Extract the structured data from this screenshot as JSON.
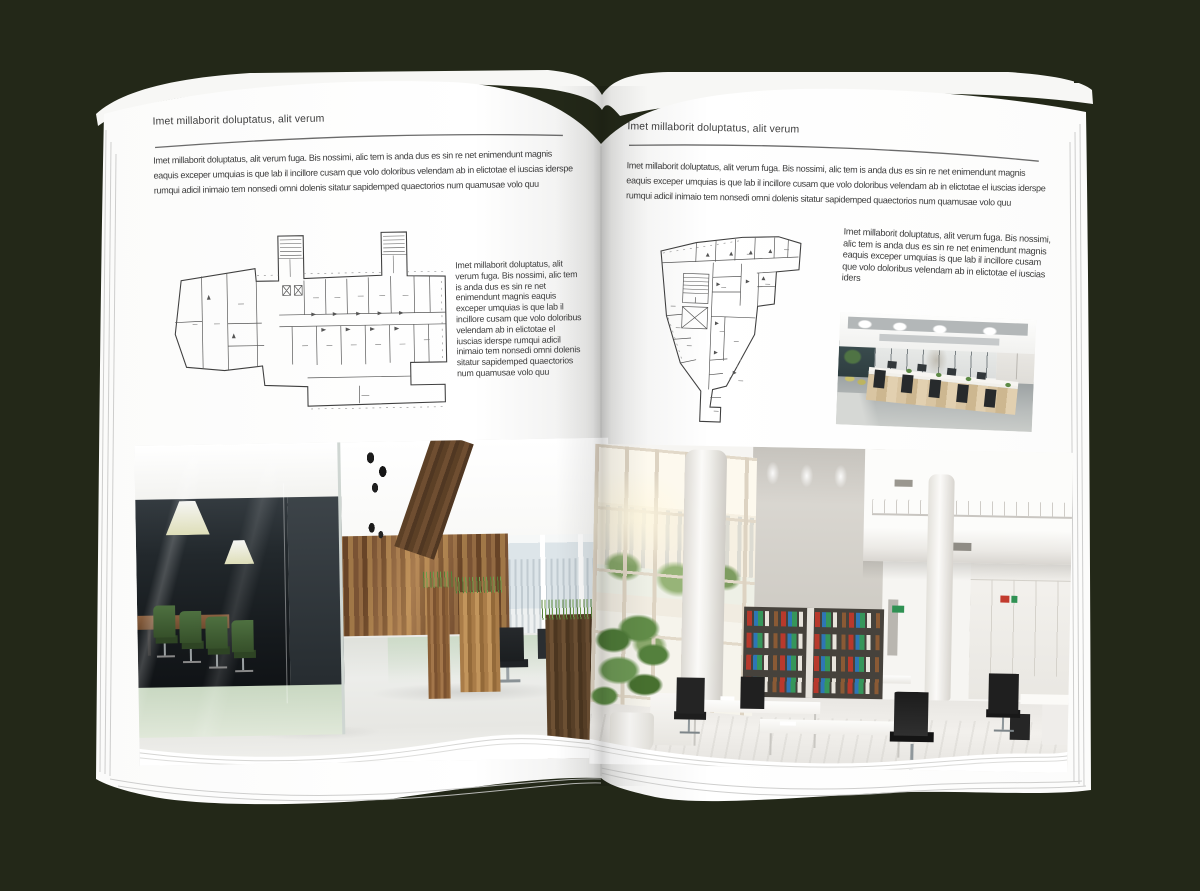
{
  "background_color": "#232818",
  "page_color": "#ffffff",
  "text_color": "#3c3c3c",
  "left_page": {
    "header": "Imet millaborit doluptatus, alit verum",
    "intro": "Imet millaborit doluptatus, alit verum fuga. Bis nossimi, alic tem is anda dus es sin re net enimendunt magnis eaquis exceper umquias is que lab il incillore cusam que volo doloribus velendam ab in elictotae el iuscias iderspe rumqui adicil inimaio tem nonsedi omni dolenis sitatur sapidemped quaectorios num quamusae volo quu",
    "side_text": "Imet millaborit doluptatus, alit verum fuga. Bis nossimi, alic tem is anda dus es sin re net enimendunt magnis eaquis exceper umquias is que lab il incillore cusam que volo doloribus velendam ab in elictotae el iuscias iderspe rumqui adicil inimaio tem nonsedi omni dolenis sitatur sapidemped quaectorios num quamusae volo quu",
    "floor_plan_icon": "building-floor-plan-wide",
    "photo_icon": "office-interior-wood-glass-meeting-room"
  },
  "right_page": {
    "header": "Imet millaborit doluptatus, alit verum",
    "intro": "Imet millaborit doluptatus, alit verum fuga. Bis nossimi, alic tem is anda dus es sin re net enimendunt magnis eaquis exceper umquias is que lab il incillore cusam que volo doloribus velendam ab in elictotae el iuscias iderspe rumqui adicil inimaio tem nonsedi omni dolenis sitatur sapidemped quaectorios num quamusae volo quu",
    "side_text": "Imet millaborit doluptatus, alit verum fuga. Bis nossimi, alic tem is anda dus es sin re net enimendunt magnis eaquis exceper umquias is que lab il incillore cusam que volo doloribus velendam ab in elictotae el iuscias iders",
    "floor_plan_icon": "building-floor-plan-tall",
    "photo_small_icon": "office-interior-open-space-desks",
    "photo_large_icon": "office-interior-white-atrium-bookshelves"
  }
}
